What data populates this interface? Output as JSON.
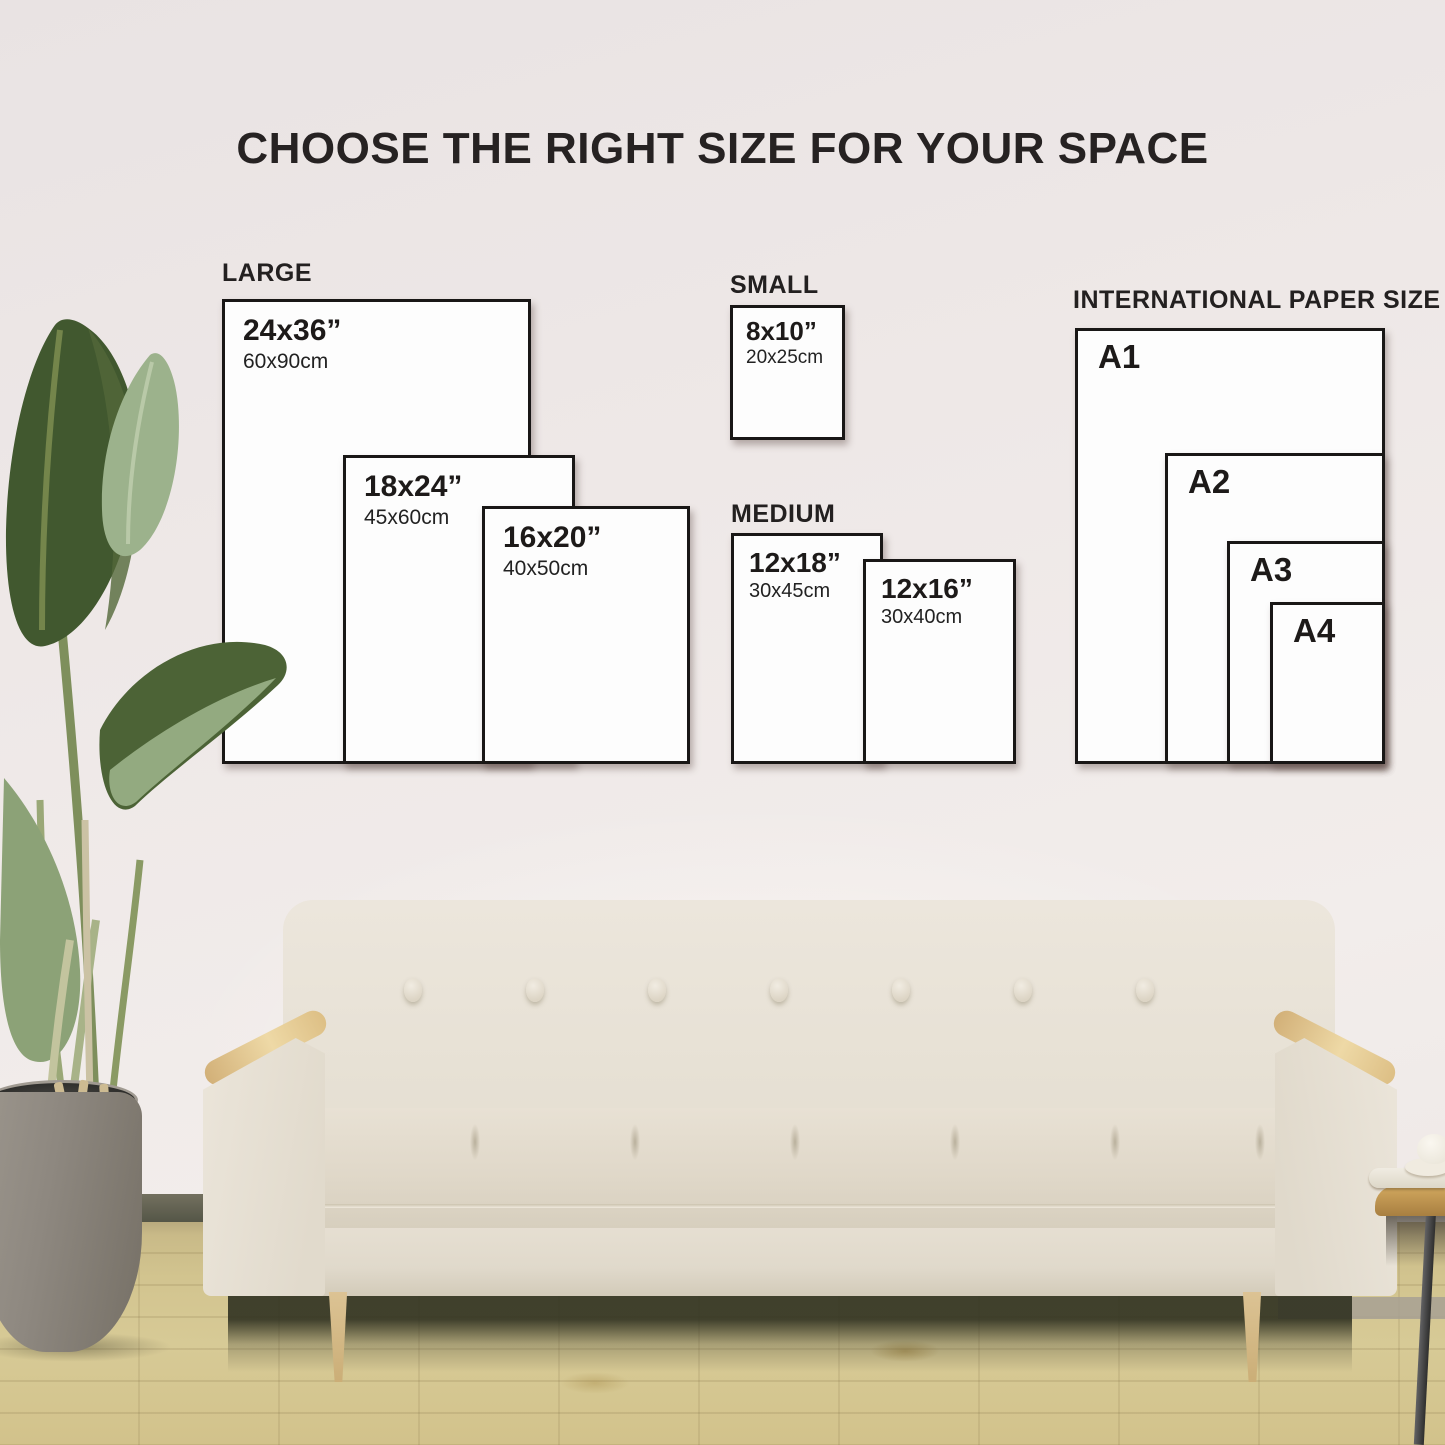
{
  "title": "CHOOSE THE RIGHT SIZE FOR YOUR SPACE",
  "groups": {
    "large": {
      "label": "LARGE",
      "sizes": [
        {
          "inches": "24x36”",
          "cm": "60x90cm"
        },
        {
          "inches": "18x24”",
          "cm": "45x60cm"
        },
        {
          "inches": "16x20”",
          "cm": "40x50cm"
        }
      ]
    },
    "small": {
      "label": "SMALL",
      "sizes": [
        {
          "inches": "8x10”",
          "cm": "20x25cm"
        }
      ]
    },
    "medium": {
      "label": "MEDIUM",
      "sizes": [
        {
          "inches": "12x18”",
          "cm": "30x45cm"
        },
        {
          "inches": "12x16”",
          "cm": "30x40cm"
        }
      ]
    },
    "international": {
      "label": "INTERNATIONAL PAPER SIZE",
      "sizes": [
        {
          "name": "A1"
        },
        {
          "name": "A2"
        },
        {
          "name": "A3"
        },
        {
          "name": "A4"
        }
      ]
    }
  },
  "palette": {
    "box_border": "#191716",
    "box_paper": "#fdfdfd",
    "text": "#1d1a19",
    "wall": "#efe9e8",
    "floor_wood": "#d2c48f",
    "sofa_fabric": "#e8e2d6",
    "armrest_wood": "#e6cb92",
    "planter_gray": "#8b857c",
    "leaf_dark_green": "#41582f",
    "leaf_light_green": "#9cb28c"
  }
}
